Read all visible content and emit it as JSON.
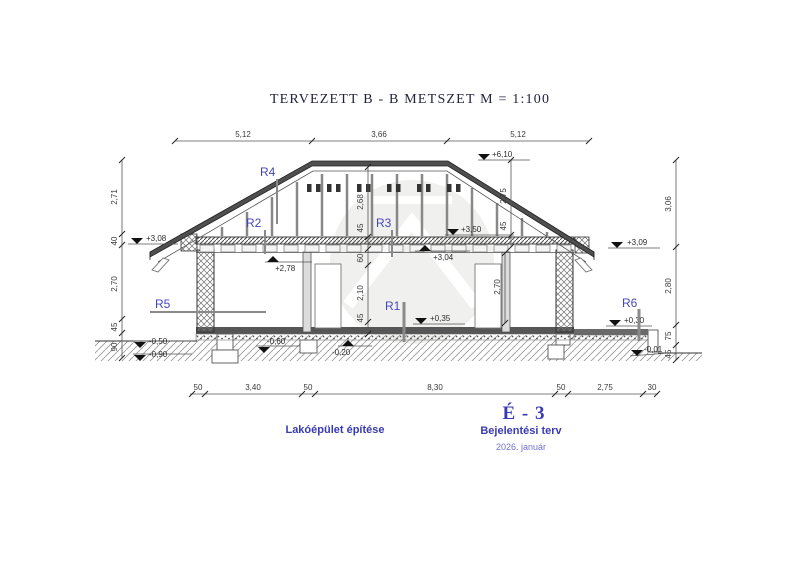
{
  "title": "TERVEZETT B - B METSZET  M = 1:100",
  "colors": {
    "accent_blue": "#3a3ab4",
    "line_dark": "#3a3a3a",
    "roof_fill": "#4f4f4f"
  },
  "dims": {
    "top": [
      "5,12",
      "3,66",
      "5,12"
    ],
    "bottom": [
      "50",
      "3,40",
      "50",
      "8,30",
      "50",
      "2,75",
      "30"
    ],
    "left": [
      "2,71",
      "40",
      "2,70",
      "45",
      "90"
    ],
    "right": [
      "3,06",
      "2,80",
      "75",
      "45"
    ],
    "center": [
      "2,68",
      "45",
      "60",
      "2,10",
      "45"
    ],
    "attic_right": [
      "2,75",
      "45"
    ],
    "room_right": [
      "2,70"
    ]
  },
  "levels": {
    "ridge": "+6,10",
    "attic_floor": "+3,50",
    "ceiling": "+3,04",
    "soffit_left": "+2,78",
    "eaves_left": "+3,08",
    "eaves_right": "+3,09",
    "floor": "+0,35",
    "terrace": "+0,30",
    "terrain_right": "-0,01",
    "terrain_left": "-0,50",
    "foundation_left": "-0,90",
    "subbase": "-0,60",
    "subgrade": "-0,20"
  },
  "r_labels": {
    "r1": "R1",
    "r2": "R2",
    "r3": "R3",
    "r4": "R4",
    "r5": "R5",
    "r6": "R6"
  },
  "footer": {
    "project_title": "Lakóépület építése",
    "sheet_number": "É - 3",
    "plan_type": "Bejelentési terv",
    "plan_date": "2026. január"
  }
}
